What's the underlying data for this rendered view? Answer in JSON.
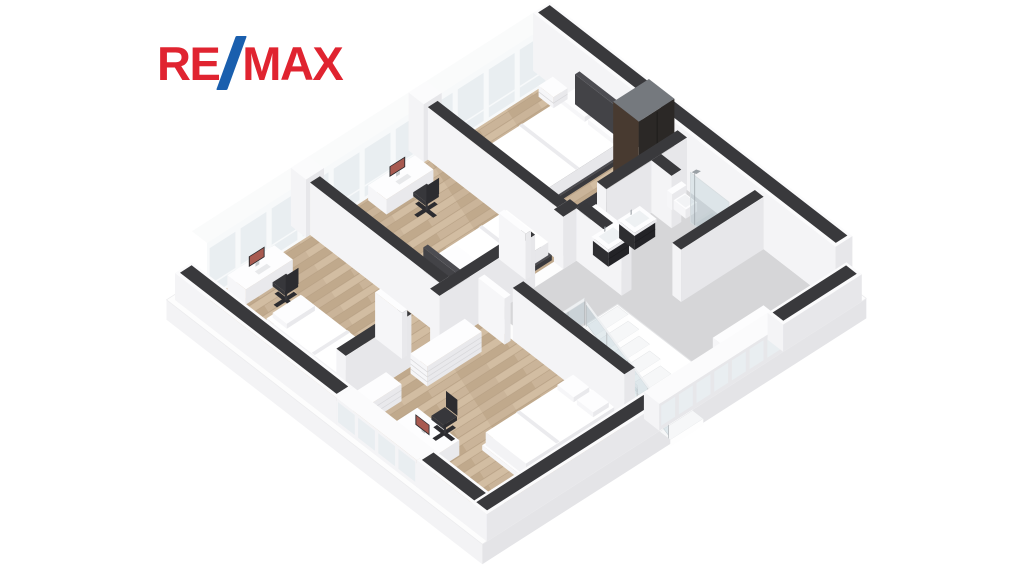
{
  "logo": {
    "brand": "RE/MAX",
    "part1": "RE",
    "part2": "MAX",
    "slash_glyph": "/"
  },
  "palette": {
    "background": "#ffffff",
    "remax_red": "#e02430",
    "remax_blue": "#1a5fae",
    "wall_top": "#39393c",
    "wall_cap_white": "#fbfbfc",
    "wall_face_light": "#f4f4f6",
    "wall_face_shade": "#e7e7ea",
    "wood": "#cab499",
    "wood_streak_dark": "#c0a98c",
    "wood_streak_light": "#d2bda2",
    "wood_gap": "#b7a084",
    "tile": "#d6d6d8",
    "glass": "#e9eef1",
    "window_frame": "#f7f9fa",
    "void_white": "#ffffff",
    "tread": "#f6f7f8",
    "tread_edge": "#e2e4e6",
    "riser": "#fefefe",
    "rail_glass": "rgba(183,204,214,0.38)",
    "rail_post": "#b8bcbf",
    "rail_top": "#eef0f2",
    "furniture_white_top": "#fdfdfe",
    "furniture_white_left": "#f6f6f8",
    "furniture_white_right": "#e9e9ec",
    "furniture_seam": "#d8d8db",
    "dark_top": "#3a3a3e",
    "dark_left": "#2e2e31",
    "dark_right": "#232327",
    "wardrobe_top": "#75797e",
    "wardrobe_left": "#483a30",
    "wardrobe_right": "#2b2826",
    "bed_frame": "#4c4c51",
    "duvet_top": "#ffffff",
    "duvet_left": "#f3f3f5",
    "duvet_right": "#e7e7ea",
    "duvet_fold": "#ebebee",
    "chair_dark": "#37373b",
    "chair_darker": "#2c2c30",
    "monitor_frame": "#2a2a2d",
    "monitor_screen": "#a85a50",
    "chrome": "#9aa0a5",
    "shower_tray": "#d2d4d6",
    "shower_tray_inner": "#c9cccf",
    "basin": "#eef1f3",
    "skirt_left": "#f3f3f5",
    "skirt_right": "#e4e4e7",
    "slab_top": "#fdfdfd"
  },
  "floorplan": {
    "type": "isometric-3d-floor-plan",
    "view": "upper floor, dollhouse cutaway, front walls cut low",
    "rooms": [
      {
        "name": "bedroom-left",
        "floor": "wood",
        "furniture": [
          "desk",
          "monitor",
          "office-chair",
          "single-bed"
        ]
      },
      {
        "name": "bedroom-middle",
        "floor": "wood",
        "furniture": [
          "long-dresser",
          "desk",
          "monitor",
          "office-chair",
          "double-bed",
          "dark-side-table"
        ]
      },
      {
        "name": "bedroom-master",
        "floor": "wood",
        "furniture": [
          "double-bed",
          "nightstand",
          "nightstand",
          "tall-wardrobe",
          "dark-counter"
        ]
      },
      {
        "name": "bedroom-bottom",
        "floor": "wood",
        "furniture": [
          "dresser",
          "dresser",
          "desk",
          "monitor",
          "office-chair",
          "single-bed"
        ]
      },
      {
        "name": "bathroom",
        "floor": "tile",
        "furniture": [
          "vanity-sink",
          "vanity-sink",
          "toilet",
          "glass-shower"
        ]
      },
      {
        "name": "hallway-landing",
        "floor": "tile",
        "furniture": [
          "window-bench"
        ]
      },
      {
        "name": "stairwell",
        "floor": "open-void",
        "furniture": [
          "staircase",
          "glass-railing"
        ]
      }
    ],
    "projection": {
      "ox": 175,
      "oy": 300,
      "ax": 37.5,
      "ay": -24,
      "bx": 33.6,
      "by": 26
    },
    "elements": [
      {
        "name": "floor-slab",
        "kind": "slab",
        "x": -0.12,
        "y": -0.12,
        "w": 10.24,
        "d": 9.4,
        "drop": 20
      },
      {
        "name": "bedroom-left-floor",
        "kind": "floor",
        "x": 0.45,
        "y": 0.45,
        "w": 2.75,
        "d": 3.85,
        "surface": "wood"
      },
      {
        "name": "bedroom-middle-floor",
        "kind": "floor",
        "x": 3.46,
        "y": 0.45,
        "w": 2.88,
        "d": 3.85,
        "surface": "wood"
      },
      {
        "name": "bedroom-master-floor",
        "kind": "floor",
        "x": 6.6,
        "y": 0.45,
        "w": 2.95,
        "d": 3.85,
        "surface": "wood"
      },
      {
        "name": "bedroom-bottom-floor",
        "kind": "floor",
        "x": 0.45,
        "y": 4.58,
        "w": 3.72,
        "d": 4.14,
        "surface": "wood"
      },
      {
        "name": "hallway-bathroom-floor",
        "kind": "floor",
        "x": 4.45,
        "y": 4.58,
        "w": 5.1,
        "d": 4.14,
        "surface": "tile"
      },
      {
        "name": "window-wall-back",
        "kind": "curtain",
        "x0": 0.45,
        "x1": 9.55,
        "y": 0.45,
        "h": 58,
        "panels": 11,
        "piers": [
          3.33,
          6.47
        ]
      },
      {
        "name": "wall-top-right",
        "kind": "wall",
        "x": 9.55,
        "y": 0,
        "w": 0.45,
        "d": 9,
        "h": 58,
        "cap": 1,
        "lip": 0.07
      },
      {
        "name": "master-bed",
        "kind": "bed",
        "x": 7.1,
        "y": 1.3,
        "w": 2.45,
        "d": 1.8,
        "axis": "x",
        "head": "x1",
        "frame": "dark",
        "pillows": 2
      },
      {
        "name": "nightstand-left",
        "kind": "box",
        "x": 9.14,
        "y": 0.62,
        "w": 0.38,
        "d": 0.44,
        "h": 11,
        "c": "white",
        "seams": 1
      },
      {
        "name": "nightstand-right",
        "kind": "box",
        "x": 9.14,
        "y": 3.26,
        "w": 0.38,
        "d": 0.44,
        "h": 11,
        "c": "white",
        "seams": 1
      },
      {
        "name": "master-counter",
        "kind": "box",
        "x": 7.1,
        "y": 3.96,
        "w": 1.35,
        "d": 0.32,
        "h": 26,
        "c": "dark"
      },
      {
        "name": "wardrobe",
        "kind": "box",
        "x": 8.55,
        "y": 3.5,
        "w": 0.95,
        "d": 0.76,
        "h": 84,
        "c": "wardrobe",
        "vseam": 1
      },
      {
        "name": "wall-middle-master",
        "kind": "wall",
        "x": 6.34,
        "y": 0.45,
        "w": 0.26,
        "d": 3.85,
        "h": 52,
        "cap": 1
      },
      {
        "name": "dresser-long",
        "kind": "box",
        "x": 3.56,
        "y": 0.62,
        "w": 0.5,
        "d": 2.6,
        "h": 20,
        "c": "white",
        "seams": 3
      },
      {
        "name": "side-table-dark",
        "kind": "box",
        "x": 3.6,
        "y": 3.3,
        "w": 0.4,
        "d": 0.4,
        "h": 22,
        "c": "dark"
      },
      {
        "name": "desk-middle",
        "kind": "box",
        "x": 4.7,
        "y": 0.5,
        "w": 1.25,
        "d": 0.55,
        "h": 15,
        "c": "white"
      },
      {
        "name": "monitor-middle",
        "kind": "monitor",
        "cx": 5.32,
        "cy": 0.68,
        "z": 15,
        "axis": "x"
      },
      {
        "name": "chair-middle",
        "kind": "chair",
        "cx": 5.35,
        "cy": 1.5,
        "facing": "y"
      },
      {
        "name": "bed-middle",
        "kind": "bed",
        "x": 4.15,
        "y": 2.9,
        "w": 2.1,
        "d": 1.34,
        "axis": "x",
        "head": "x0",
        "frame": "dark",
        "pillows": 1
      },
      {
        "name": "wall-left-middle",
        "kind": "wall",
        "x": 3.2,
        "y": 0.45,
        "w": 0.26,
        "d": 3.85,
        "h": 52,
        "cap": 1
      },
      {
        "name": "desk-left",
        "kind": "box",
        "x": 0.95,
        "y": 0.5,
        "w": 1.25,
        "d": 0.55,
        "h": 15,
        "c": "white"
      },
      {
        "name": "monitor-left",
        "kind": "monitor",
        "cx": 1.57,
        "cy": 0.68,
        "z": 15,
        "axis": "x"
      },
      {
        "name": "chair-left",
        "kind": "chair",
        "cx": 1.6,
        "cy": 1.5,
        "facing": "y"
      },
      {
        "name": "bed-left",
        "kind": "bed",
        "x": 0.6,
        "y": 1.95,
        "w": 1.05,
        "d": 2.25,
        "axis": "y",
        "head": "y0",
        "frame": "none",
        "pillows": 1
      },
      {
        "name": "hall-wall-1",
        "kind": "wall",
        "x": 0.45,
        "y": 4.3,
        "w": 1.75,
        "d": 0.28,
        "h": 52,
        "cap": 1
      },
      {
        "name": "hall-wall-2",
        "kind": "wall",
        "x": 2.95,
        "y": 4.3,
        "w": 2.55,
        "d": 0.28,
        "h": 52,
        "cap": 1
      },
      {
        "name": "hall-wall-3",
        "kind": "wall",
        "x": 6.25,
        "y": 4.3,
        "w": 0.43,
        "d": 0.28,
        "h": 52,
        "cap": 1
      },
      {
        "name": "hall-wall-4",
        "kind": "wall",
        "x": 7.4,
        "y": 4.3,
        "w": 2.15,
        "d": 0.28,
        "h": 52,
        "cap": 1
      },
      {
        "name": "door-bedroom-left",
        "kind": "door",
        "x": 2.2,
        "y": 3.5,
        "w": 0.14,
        "d": 0.8
      },
      {
        "name": "door-bedroom-middle",
        "kind": "door",
        "x": 5.5,
        "y": 3.5,
        "w": 0.14,
        "d": 0.8
      },
      {
        "name": "door-master",
        "kind": "door",
        "x": 6.95,
        "y": 4.62,
        "w": 0.14,
        "d": 0.78
      },
      {
        "name": "wall-bath-left",
        "kind": "wall",
        "x": 6.6,
        "y": 4.58,
        "w": 0.26,
        "d": 1.35,
        "h": 52,
        "cap": 1
      },
      {
        "name": "vanity-sink-1",
        "kind": "vanity",
        "x": 6.95,
        "y": 4.68,
        "w": 0.55,
        "d": 0.46
      },
      {
        "name": "vanity-sink-2",
        "kind": "vanity",
        "x": 7.65,
        "y": 4.68,
        "w": 0.55,
        "d": 0.46
      },
      {
        "name": "wall-wc",
        "kind": "wall",
        "x": 8.6,
        "y": 4.58,
        "w": 0.26,
        "d": 0.6,
        "h": 52,
        "cap": 1
      },
      {
        "name": "toilet",
        "kind": "toilet",
        "x": 8.95,
        "y": 4.66
      },
      {
        "name": "shower",
        "kind": "shower",
        "x": 8.95,
        "y": 5.35,
        "w": 0.58,
        "d": 1.15
      },
      {
        "name": "wall-bath-south",
        "kind": "wall",
        "x": 7.35,
        "y": 6.6,
        "w": 2.2,
        "d": 0.26,
        "h": 52,
        "cap": 1
      },
      {
        "name": "window-bench",
        "kind": "box",
        "x": 6.95,
        "y": 8.25,
        "w": 1.35,
        "d": 0.35,
        "h": 10,
        "c": "white"
      },
      {
        "name": "stair-void",
        "kind": "void",
        "x": 4.62,
        "y": 6.05,
        "w": 1.76,
        "d": 2.55
      },
      {
        "name": "staircase",
        "kind": "stairs",
        "x": 5.5,
        "y0": 6.05,
        "w": 0.88,
        "steps": 8,
        "depth": 0.319,
        "z0": -2,
        "dz": -6.6
      },
      {
        "name": "stair-railing-top",
        "kind": "railx",
        "x0": 4.62,
        "x1": 5.5,
        "y": 6.05,
        "posts": 2
      },
      {
        "name": "stair-railing-side",
        "kind": "raily",
        "x": 4.62,
        "y0": 6.05,
        "y1": 8.6,
        "posts": 5
      },
      {
        "name": "stair-railing-slope",
        "kind": "railslope",
        "x": 5.5,
        "y0": 6.1,
        "y1": 8.55,
        "za": 0,
        "zb": -48
      },
      {
        "name": "wall-bottomroom-hall",
        "kind": "wall",
        "x": 4.17,
        "y": 5.4,
        "w": 0.28,
        "d": 3.32,
        "h": 52,
        "cap": 1
      },
      {
        "name": "door-bedroom-bottom",
        "kind": "door",
        "x": 3.97,
        "y": 4.6,
        "w": 0.16,
        "d": 0.78
      },
      {
        "name": "dresser-bottom-long",
        "kind": "box",
        "x": 2.05,
        "y": 4.72,
        "w": 1.45,
        "d": 0.5,
        "h": 20,
        "c": "white",
        "seams": 3
      },
      {
        "name": "dresser-bottom-small",
        "kind": "box",
        "x": 0.62,
        "y": 4.72,
        "w": 0.78,
        "d": 0.46,
        "h": 17,
        "c": "white",
        "seams": 2
      },
      {
        "name": "desk-bottom",
        "kind": "box",
        "x": 0.6,
        "y": 5.85,
        "w": 0.62,
        "d": 1.25,
        "h": 15,
        "c": "white"
      },
      {
        "name": "monitor-bottom",
        "kind": "monitor",
        "cx": 0.82,
        "cy": 6.45,
        "z": 15,
        "axis": "y"
      },
      {
        "name": "chair-bottom",
        "kind": "chair",
        "cx": 1.4,
        "cy": 6.45,
        "facing": "x"
      },
      {
        "name": "bed-bottom",
        "kind": "bed",
        "x": 1.65,
        "y": 7.3,
        "w": 2.45,
        "d": 1.3,
        "axis": "x",
        "head": "x1",
        "frame": "none",
        "pillows": 2
      },
      {
        "name": "front-left-wall-1",
        "kind": "wall",
        "x": 0,
        "y": 0,
        "w": 0.45,
        "d": 4.8,
        "h": 27,
        "cap": 1,
        "lip": 0.07
      },
      {
        "name": "front-left-window",
        "kind": "lowglass",
        "x": 0,
        "y": 4.8,
        "w": 0.45,
        "d": 2.4,
        "h": 27,
        "axis": "x",
        "panels": 4
      },
      {
        "name": "front-left-wall-2",
        "kind": "wall",
        "x": 0,
        "y": 7.2,
        "w": 0.45,
        "d": 2.08,
        "h": 27,
        "cap": 1,
        "lip": 0.07
      },
      {
        "name": "front-right-wall-1",
        "kind": "wall",
        "x": 0,
        "y": 8.82,
        "w": 4.6,
        "d": 0.46,
        "h": 27,
        "cap": 1,
        "lip": 0.07
      },
      {
        "name": "front-right-window",
        "kind": "lowglass",
        "x": 4.6,
        "y": 8.82,
        "w": 3.3,
        "d": 0.46,
        "h": 27,
        "axis": "y",
        "panels": 7
      },
      {
        "name": "front-right-wall-2",
        "kind": "wall",
        "x": 7.9,
        "y": 8.82,
        "w": 2.1,
        "d": 0.46,
        "h": 27,
        "cap": 1,
        "lip": 0.07
      }
    ]
  }
}
